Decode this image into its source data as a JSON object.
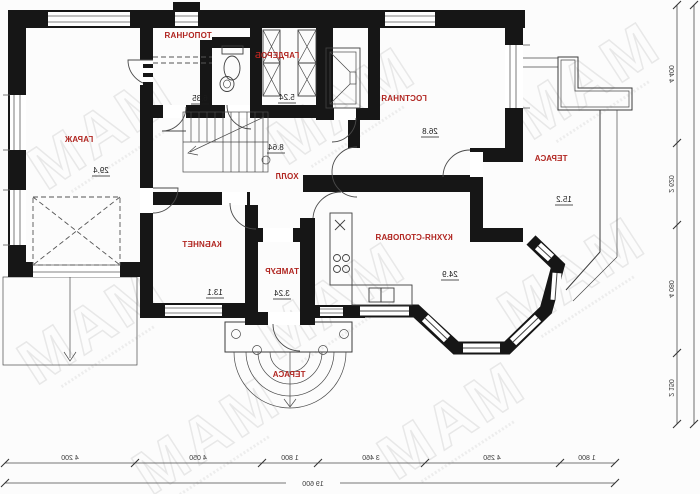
{
  "title": "house-first-floor-plan",
  "rooms": [
    {
      "name": "ТОПОЧНАЯ",
      "area": "6.35"
    },
    {
      "name": "ГАРДЕРОБ",
      "area": "5.24"
    },
    {
      "name": "ГАРАЖ",
      "area": "29.4"
    },
    {
      "name": "ХОЛЛ",
      "area": "8.64"
    },
    {
      "name": "ГОСТИНАЯ",
      "area": "26.8"
    },
    {
      "name": "ТЕРАСА",
      "area": "15.2"
    },
    {
      "name": "КУХНЯ-СТОЛОВАЯ",
      "area": "24.9"
    },
    {
      "name": "КАБИНЕТ",
      "area": "13.1"
    },
    {
      "name": "ТАМБУР",
      "area": "3.24"
    },
    {
      "name": "ТЕРАСА",
      "area": ""
    }
  ],
  "dimensions": {
    "bottom": [
      "4 200",
      "4 050",
      "1 800",
      "3 460",
      "4 250",
      "1 800"
    ],
    "bottom_total": "19 600",
    "side": [
      "4 400",
      "2 620",
      "4 080",
      "2 150"
    ],
    "side_total": "13 250"
  },
  "watermark": {
    "logo": "МАМ"
  },
  "colors": {
    "label_red": "#b02520",
    "wall_black": "#161616"
  }
}
